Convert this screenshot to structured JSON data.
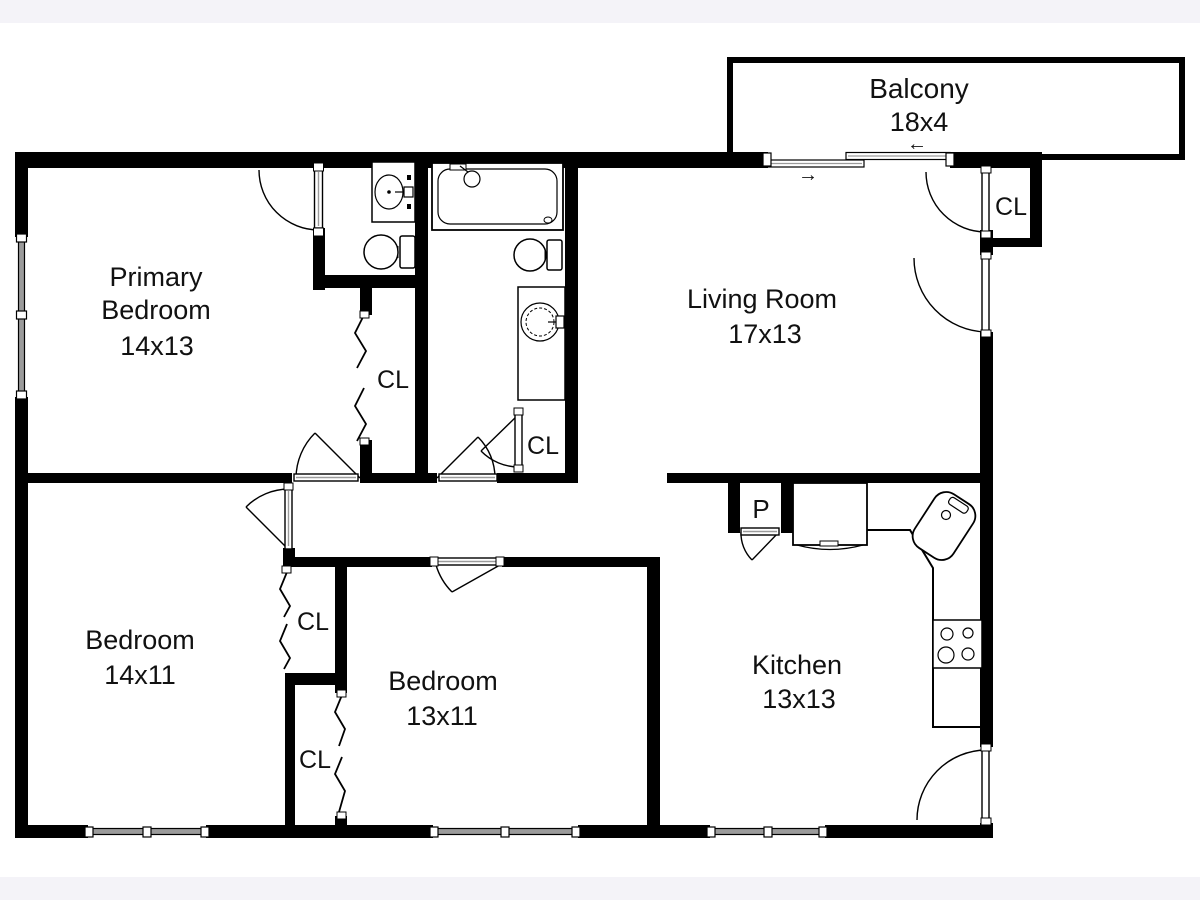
{
  "floor_plan": {
    "rooms": [
      {
        "id": "primary-bedroom",
        "lines": [
          "Primary",
          "Bedroom"
        ],
        "dimensions": "14x13"
      },
      {
        "id": "living-room",
        "lines": [
          "Living Room"
        ],
        "dimensions": "17x13"
      },
      {
        "id": "balcony",
        "lines": [
          "Balcony"
        ],
        "dimensions": "18x4"
      },
      {
        "id": "bedroom-left",
        "lines": [
          "Bedroom"
        ],
        "dimensions": "14x11"
      },
      {
        "id": "bedroom-middle",
        "lines": [
          "Bedroom"
        ],
        "dimensions": "13x11"
      },
      {
        "id": "kitchen",
        "lines": [
          "Kitchen"
        ],
        "dimensions": "13x13"
      }
    ],
    "labels": {
      "closet": "CL",
      "pantry": "P"
    },
    "slider_arrows": {
      "left": "←",
      "right": "→"
    },
    "colors": {
      "wall": "#000000",
      "floor": "#ffffff",
      "page_band": "#f4f3f8",
      "window": "#9b9b9b"
    }
  }
}
